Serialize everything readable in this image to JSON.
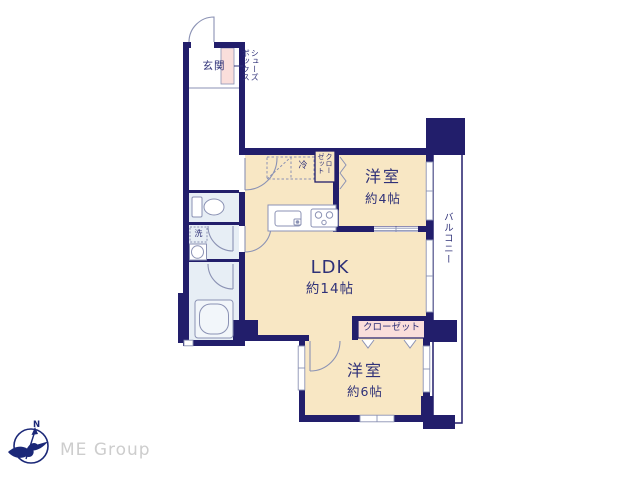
{
  "colors": {
    "wall_navy": "#221e6b",
    "room_beige": "#f8e7c4",
    "closet_pink": "#fadedb",
    "wet_area_blue": "#e7eef5",
    "fixture_line_gray": "#8b92b4",
    "label_navy": "#2f3178",
    "logo_navy": "#1b2878",
    "company_gray": "#cdcdcd"
  },
  "rooms": {
    "genkan": {
      "name": "玄関"
    },
    "shoes_box": {
      "line1": "シューズ",
      "line2": "ボックス"
    },
    "laundry": {
      "mark": "洗"
    },
    "refrigerator": {
      "mark": "冷"
    },
    "closet_ldk": {
      "line1": "クロー",
      "line2": "ゼット"
    },
    "ldk": {
      "name": "LDK",
      "size": "約14帖"
    },
    "western_room_4": {
      "name": "洋室",
      "size": "約4帖"
    },
    "balcony": {
      "name": "バルコニー"
    },
    "closet_6": {
      "name": "クローゼット"
    },
    "western_room_6": {
      "name": "洋室",
      "size": "約6帖"
    }
  },
  "footer": {
    "company": "ME Group",
    "north": "N"
  }
}
